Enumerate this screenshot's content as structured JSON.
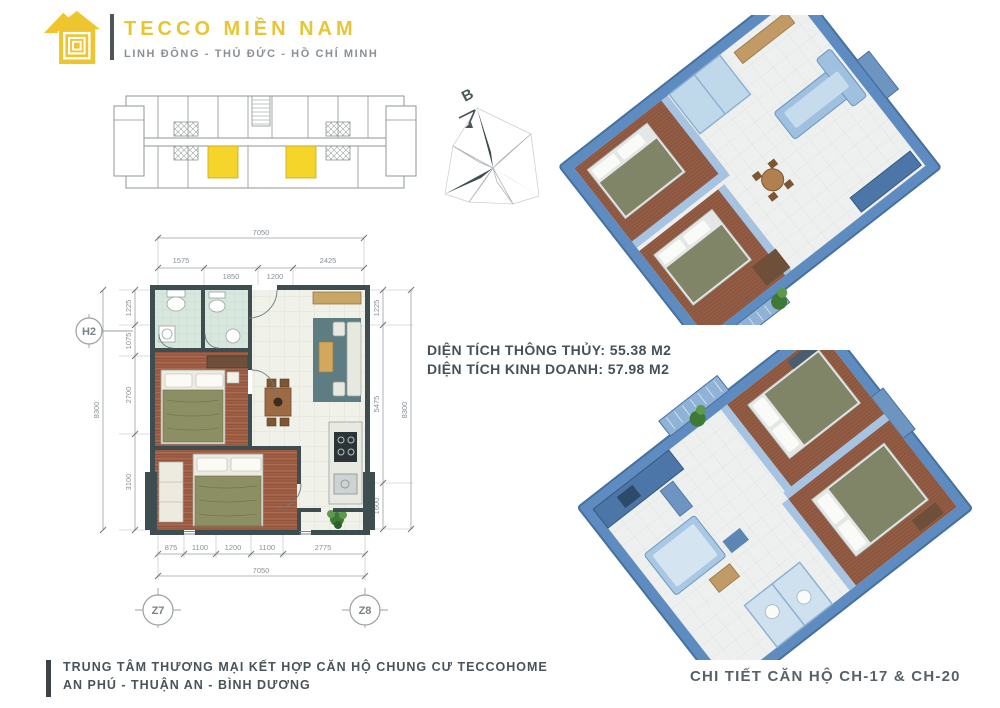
{
  "brand": {
    "name": "TECCO MIỀN NAM",
    "tagline": "LINH ĐÔNG - THỦ ĐỨC - HỒ CHÍ MINH"
  },
  "colors": {
    "brand_yellow": "#EFC52F",
    "unit_highlight": "#F6D52B",
    "wall_dark": "#3E4D4F",
    "render_blue": "#5E8CC0",
    "text_dark": "#44515B",
    "text_gray": "#8A9095"
  },
  "compass": {
    "north_label": "B"
  },
  "plan": {
    "bubbles": {
      "left": "H2",
      "bottom_left": "Z7",
      "bottom_right": "Z8"
    },
    "dims": {
      "top_total": "7050",
      "top_segments": [
        "1575",
        "1850",
        "1200",
        "2425"
      ],
      "bottom_segments": [
        "875",
        "1100",
        "1200",
        "1100",
        "2775"
      ],
      "bottom_total": "7050",
      "left_segments": [
        "1225",
        "1075",
        "2700",
        "3100"
      ],
      "left_total": "8300",
      "right_segments": [
        "1225",
        "5475",
        "1600"
      ],
      "right_total": "8300"
    }
  },
  "areas": [
    {
      "label": "DIỆN TÍCH THÔNG THỦY:",
      "value": "55.38 M2"
    },
    {
      "label": "DIỆN TÍCH KINH DOANH:",
      "value": "57.98 M2"
    }
  ],
  "footer": {
    "project_line1": "TRUNG TÂM THƯƠNG MẠI KẾT HỢP CĂN HỘ CHUNG CƯ TECCOHOME",
    "project_line2": "AN PHÚ - THUẬN AN - BÌNH DƯƠNG",
    "detail_caption": "CHI TIẾT CĂN HỘ CH-17 & CH-20"
  }
}
